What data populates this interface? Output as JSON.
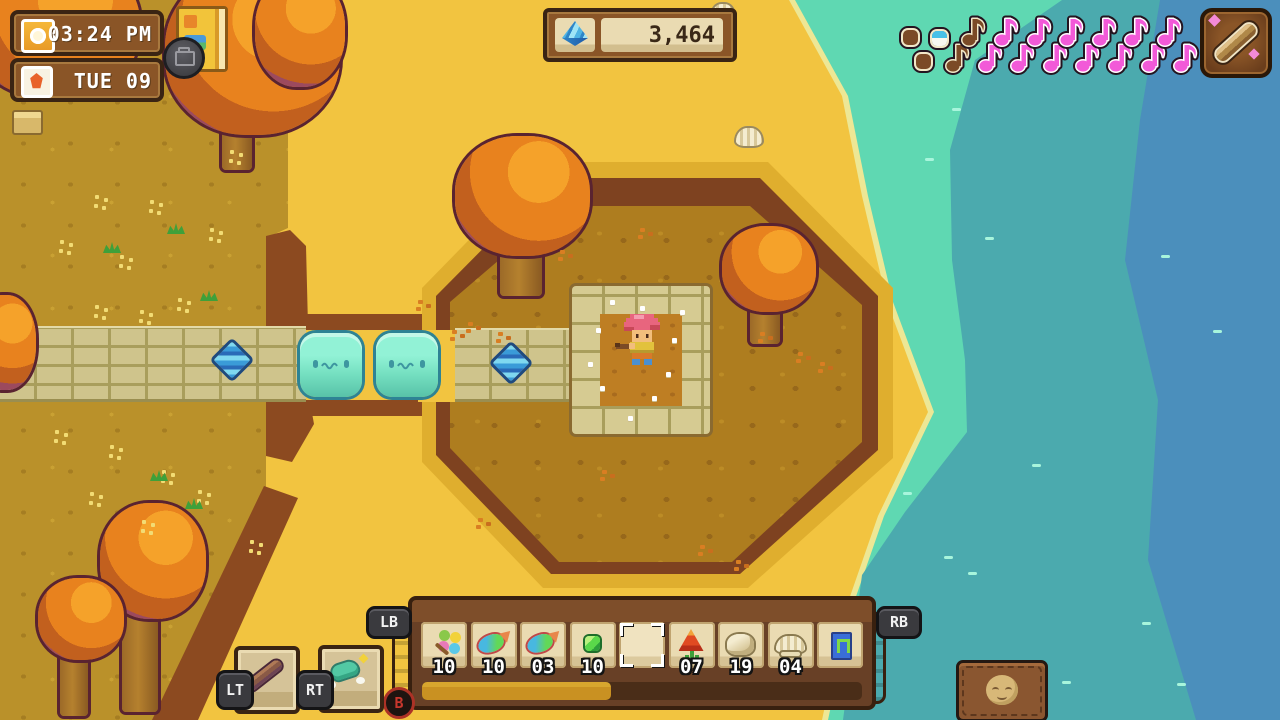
{
  "hud": {
    "clock": {
      "time": "03:24 PM",
      "date": "TUE 09"
    },
    "currency": {
      "amount": "3,464",
      "icon": "blue-gem"
    },
    "map_buttons": {
      "journal": "journal-book",
      "camera": "camera"
    },
    "music": {
      "instrument": "flute",
      "notes": [
        {
          "kind": "dot",
          "state": "played"
        },
        {
          "kind": "dot",
          "state": "played"
        },
        {
          "kind": "dot",
          "state": "current"
        },
        {
          "kind": "note",
          "state": "played"
        },
        {
          "kind": "note",
          "state": "played"
        },
        {
          "kind": "note",
          "state": "upcoming"
        },
        {
          "kind": "note",
          "state": "upcoming"
        },
        {
          "kind": "note",
          "state": "upcoming"
        },
        {
          "kind": "note",
          "state": "upcoming"
        },
        {
          "kind": "note",
          "state": "upcoming"
        },
        {
          "kind": "note",
          "state": "upcoming"
        },
        {
          "kind": "note",
          "state": "upcoming"
        },
        {
          "kind": "note",
          "state": "upcoming"
        },
        {
          "kind": "note",
          "state": "upcoming"
        },
        {
          "kind": "note",
          "state": "upcoming"
        },
        {
          "kind": "note",
          "state": "upcoming"
        },
        {
          "kind": "note",
          "state": "upcoming"
        },
        {
          "kind": "note",
          "state": "upcoming"
        }
      ]
    },
    "controller_hints": {
      "lb": "LB",
      "rb": "RB",
      "lt": "LT",
      "rt": "RT",
      "b": "B"
    },
    "quick_items": {
      "lt_item": "flute",
      "rt_item": "dash-boots"
    },
    "hotbar": {
      "slots": [
        {
          "item": "pinwheel-flower",
          "qty": "10",
          "selected": false
        },
        {
          "item": "fish",
          "qty": "10",
          "selected": false
        },
        {
          "item": "fish",
          "qty": "03",
          "selected": false
        },
        {
          "item": "green-gem",
          "qty": "10",
          "selected": false
        },
        {
          "item": "",
          "qty": "",
          "selected": true
        },
        {
          "item": "red-flower",
          "qty": "07",
          "selected": false
        },
        {
          "item": "rock",
          "qty": "19",
          "selected": false
        },
        {
          "item": "shell",
          "qty": "04",
          "selected": false
        },
        {
          "item": "portal-card",
          "qty": "",
          "selected": false
        }
      ],
      "progress_percent": 43
    },
    "pouch": "companion-pouch"
  },
  "scene": {
    "slime_count": 2,
    "player": "character-playing-flute"
  },
  "colors": {
    "note_pink": "#F25AD8",
    "sand": "#F2C440",
    "grass": "#BA912A",
    "water_shallow": "#5FD8B2",
    "water_mid": "#4BAAAE",
    "water_deep": "#4B8FBC",
    "hud_brown": "#8A5527",
    "hud_beige": "#EADBB2"
  }
}
